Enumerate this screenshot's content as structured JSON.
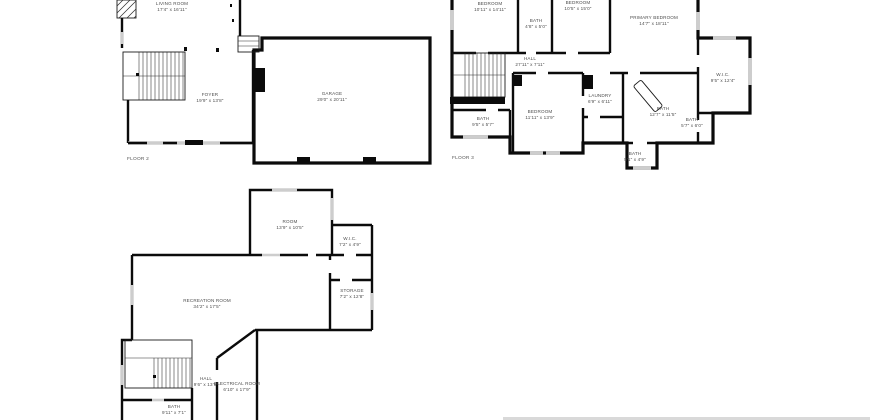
{
  "floors": [
    {
      "label": "FLOOR 2",
      "rooms": [
        {
          "name": "LIVING ROOM",
          "dims": "17'4\" x 16'11\""
        },
        {
          "name": "FOYER",
          "dims": "19'9\" x 13'8\""
        },
        {
          "name": "GARAGE",
          "dims": "29'0\" x 20'11\""
        }
      ]
    },
    {
      "label": "FLOOR 3",
      "rooms": [
        {
          "name": "BEDROOM",
          "dims": "10'11\" x 14'11\""
        },
        {
          "name": "BATH",
          "dims": "4'8\" x 5'0\""
        },
        {
          "name": "BEDROOM",
          "dims": "10'5\" x 15'0\""
        },
        {
          "name": "PRIMARY BEDROOM",
          "dims": "14'7\" x 18'11\""
        },
        {
          "name": "HALL",
          "dims": "27'11\" x 7'11\""
        },
        {
          "name": "W.I.C.",
          "dims": "9'5\" x 12'4\""
        },
        {
          "name": "LAUNDRY",
          "dims": "6'9\" x 6'11\""
        },
        {
          "name": "BEDROOM",
          "dims": "11'11\" x 13'9\""
        },
        {
          "name": "BATH",
          "dims": "9'5\" x 5'7\""
        },
        {
          "name": "BATH",
          "dims": "12'7\" x 11'5\""
        },
        {
          "name": "BATH",
          "dims": "5'7\" x 6'0\""
        },
        {
          "name": "BATH",
          "dims": "5'1\" x 4'9\""
        }
      ]
    },
    {
      "rooms": [
        {
          "name": "ROOM",
          "dims": "13'9\" x 10'5\""
        },
        {
          "name": "W.I.C.",
          "dims": "7'2\" x 4'9\""
        },
        {
          "name": "RECREATION ROOM",
          "dims": "34'2\" x 17'5\""
        },
        {
          "name": "STORAGE",
          "dims": "7'2\" x 12'8\""
        },
        {
          "name": "HALL",
          "dims": "9'6\" x 13'5\""
        },
        {
          "name": "ELECTRICAL ROOM",
          "dims": "6'10\" x 17'9\""
        },
        {
          "name": "BATH",
          "dims": "9'11\" x 7'1\""
        }
      ]
    }
  ],
  "colors": {
    "wall": "#0b0b0b",
    "window": "#cdcdcd",
    "label": "#4d4d4d",
    "background": "#ffffff"
  }
}
